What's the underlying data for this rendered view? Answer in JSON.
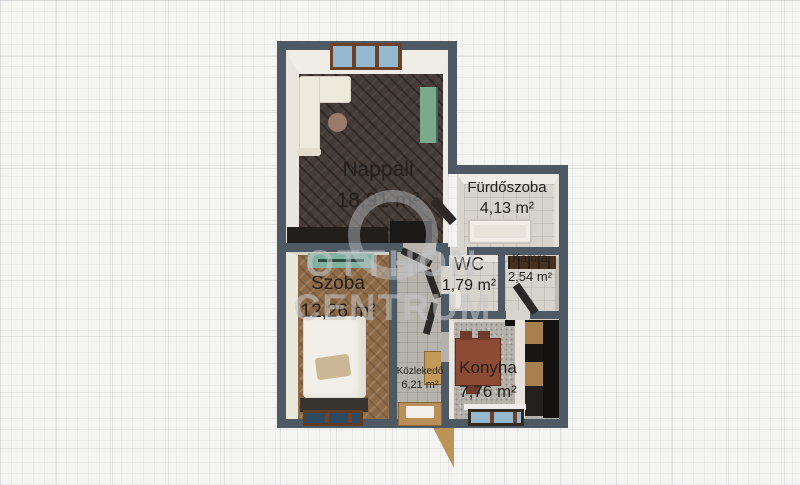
{
  "watermark": {
    "line1": "OTTHON",
    "line2": "CENTRUM"
  },
  "rooms": {
    "nappali": {
      "name": "Nappali",
      "area": "18,91 m²"
    },
    "furdoszoba": {
      "name": "Fürdőszoba",
      "area": "4,13 m²"
    },
    "wc": {
      "name": "WC",
      "area": "1,79 m²"
    },
    "kamra": {
      "name": "Kamra",
      "area": "2,54 m²"
    },
    "szoba": {
      "name": "Szoba",
      "area": "12,26 m²"
    },
    "kozlekedo": {
      "name": "Közlekedő",
      "area": "6,21 m²"
    },
    "konyha": {
      "name": "Konyha",
      "area": "7,76 m²"
    }
  },
  "colors": {
    "wall": "#4e5963",
    "background": "#f5f5f4",
    "floor_living": "#443b36",
    "floor_bedroom": "#8d6b49",
    "floor_tile": "#d7d3cd",
    "floor_hall": "#b7b3ad",
    "floor_kitchen": "#b4b0aa",
    "accent_teal": "#7aa98d",
    "glass_blue": "#94b9ce",
    "glass_dark": "#2d4a60",
    "frame_brown": "#6e4228",
    "door_tan": "#bd9356",
    "furniture_black": "#211e1c",
    "sofa_cream": "#ede9dd",
    "label_text": "#24201d",
    "watermark": "#c6c8cb"
  }
}
